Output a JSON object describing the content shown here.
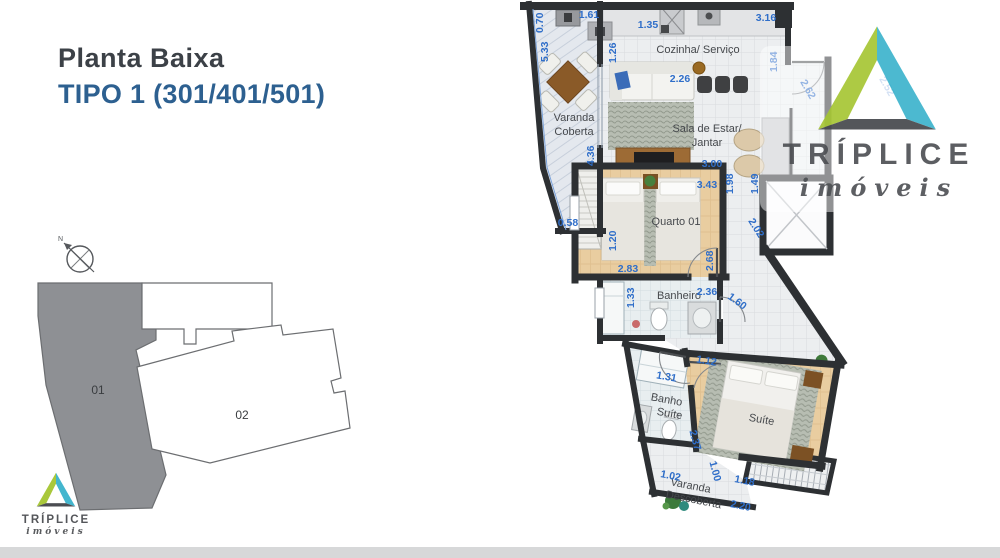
{
  "header": {
    "title": "Planta Baixa",
    "subtitle": "TIPO 1 (301/401/501)"
  },
  "site_plan": {
    "north_label": "N",
    "building_01": "01",
    "building_02": "02"
  },
  "floor_plan": {
    "labels": {
      "varanda_coberta_1": "Varanda",
      "varanda_coberta_2": "Coberta",
      "cozinha": "Cozinha/ Serviço",
      "sala_1": "Sala de Estar/",
      "sala_2": "Jantar",
      "quarto": "Quarto 01",
      "banheiro": "Banheiro",
      "banho_suite_1": "Banho",
      "banho_suite_2": "Suíte",
      "suite": "Suíte",
      "varanda_descoberta_1": "Varanda",
      "varanda_descoberta_2": "Descoberta"
    },
    "dims": {
      "d01": "0.70",
      "d02": "1.61",
      "d03": "1.35",
      "d04": "3.16",
      "d05": "5.33",
      "d06": "1.26",
      "d07": "1.84",
      "d08": "2.62",
      "d09": "2.52",
      "d10": "2.26",
      "d11": "4.36",
      "d12": "0.58",
      "d13": "3.00",
      "d14": "1.98",
      "d15": "1.49",
      "d16": "3.43",
      "d17": "1.20",
      "d18": "2.02",
      "d19": "2.83",
      "d20": "2.68",
      "d21": "1.33",
      "d22": "2.36",
      "d23": "1.60",
      "d24": "1.12",
      "d25": "1.31",
      "d26": "2.37",
      "d27": "1.02",
      "d28": "1.00",
      "d29": "1.18",
      "d30": "2.20"
    }
  },
  "branding": {
    "name": "TRÍPLICE",
    "tagline": "imóveis"
  },
  "colors": {
    "title_text": "#3c4147",
    "subtitle_blue": "#2d6090",
    "dimension_blue": "#2f6ec9",
    "wall_dark": "#2d3033",
    "site_building_gray": "#8e9094",
    "logo_green": "#a9c83b",
    "logo_teal": "#43b6ce",
    "logo_dark_gray": "#54565a",
    "footer_gray": "#d7d8d9"
  }
}
